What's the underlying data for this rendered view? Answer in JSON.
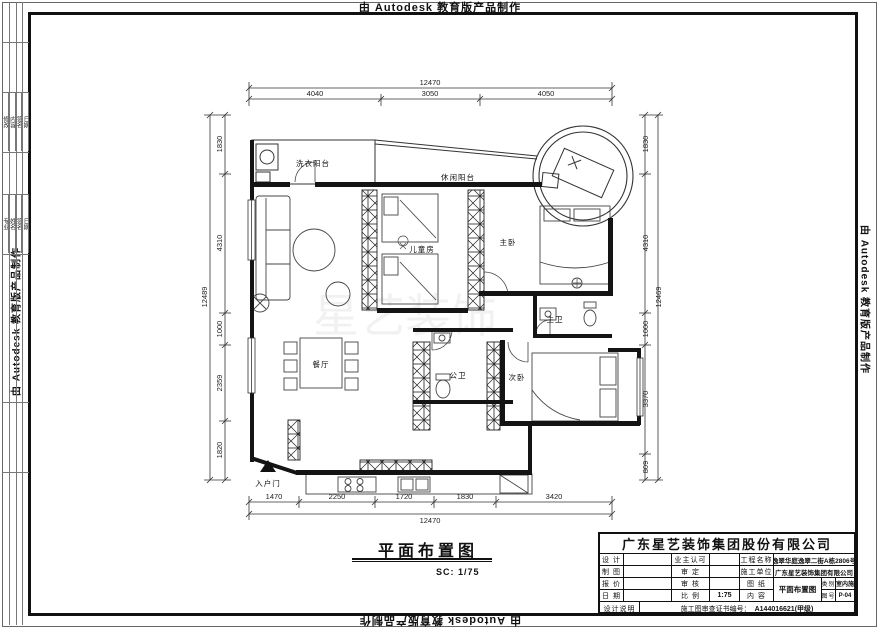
{
  "watermark": "由 Autodesk 教育版产品制作",
  "plan_watermark": "星艺装饰",
  "edge_strip": {
    "table1": [
      "修改",
      "内容",
      "签名",
      "日期"
    ],
    "table2": [
      "专业",
      "姓名",
      "签名",
      "日期"
    ]
  },
  "drawing_title": {
    "name": "平面布置图",
    "scale": "SC: 1/75"
  },
  "rooms": {
    "laundry_balcony": "洗衣阳台",
    "leisure_balcony": "休闲阳台",
    "kids_room": "儿童房",
    "master_bedroom": "主卧",
    "master_bath": "主卫",
    "public_bath": "公卫",
    "second_bedroom": "次卧",
    "dining": "餐厅",
    "entry": "入户门"
  },
  "dims": {
    "top": {
      "total": "12470",
      "segments": [
        "4040",
        "3050",
        "4050"
      ]
    },
    "bottom": {
      "total": "12470",
      "segments": [
        "1470",
        "2250",
        "1720",
        "1830",
        "3420"
      ]
    },
    "left": {
      "total": "12489",
      "segments": [
        "1830",
        "4310",
        "1000",
        "2359",
        "1820"
      ]
    },
    "right": {
      "total": "12469",
      "segments": [
        "1830",
        "4310",
        "1000",
        "3370",
        "809"
      ]
    }
  },
  "title_block": {
    "company": "广东星艺装饰集团股份有限公司",
    "design_label": "设 计",
    "owner_label": "业主认可",
    "project_label": "工程名称",
    "project_value": "逸翠华庭逸翠二街A栋2806号",
    "draft_label": "制 图",
    "approve_label": "审 定",
    "builder_label": "施工单位",
    "builder_value": "广东星艺装饰集团有限公司",
    "quote_label": "报 价",
    "review_label": "审 核",
    "sheet_label": "图 纸",
    "date_label": "日 期",
    "scale_label": "比 例",
    "scale_value": "1:75",
    "content_label": "内 容",
    "drawing_name": "平面布置图",
    "category_label": "类别",
    "category_value": "室内施",
    "number_label": "图号",
    "number_value": "P-04",
    "note_label": "设计说明",
    "cert_label": "施工图审查证书编号：",
    "cert_value": "A144016621(甲级)"
  }
}
